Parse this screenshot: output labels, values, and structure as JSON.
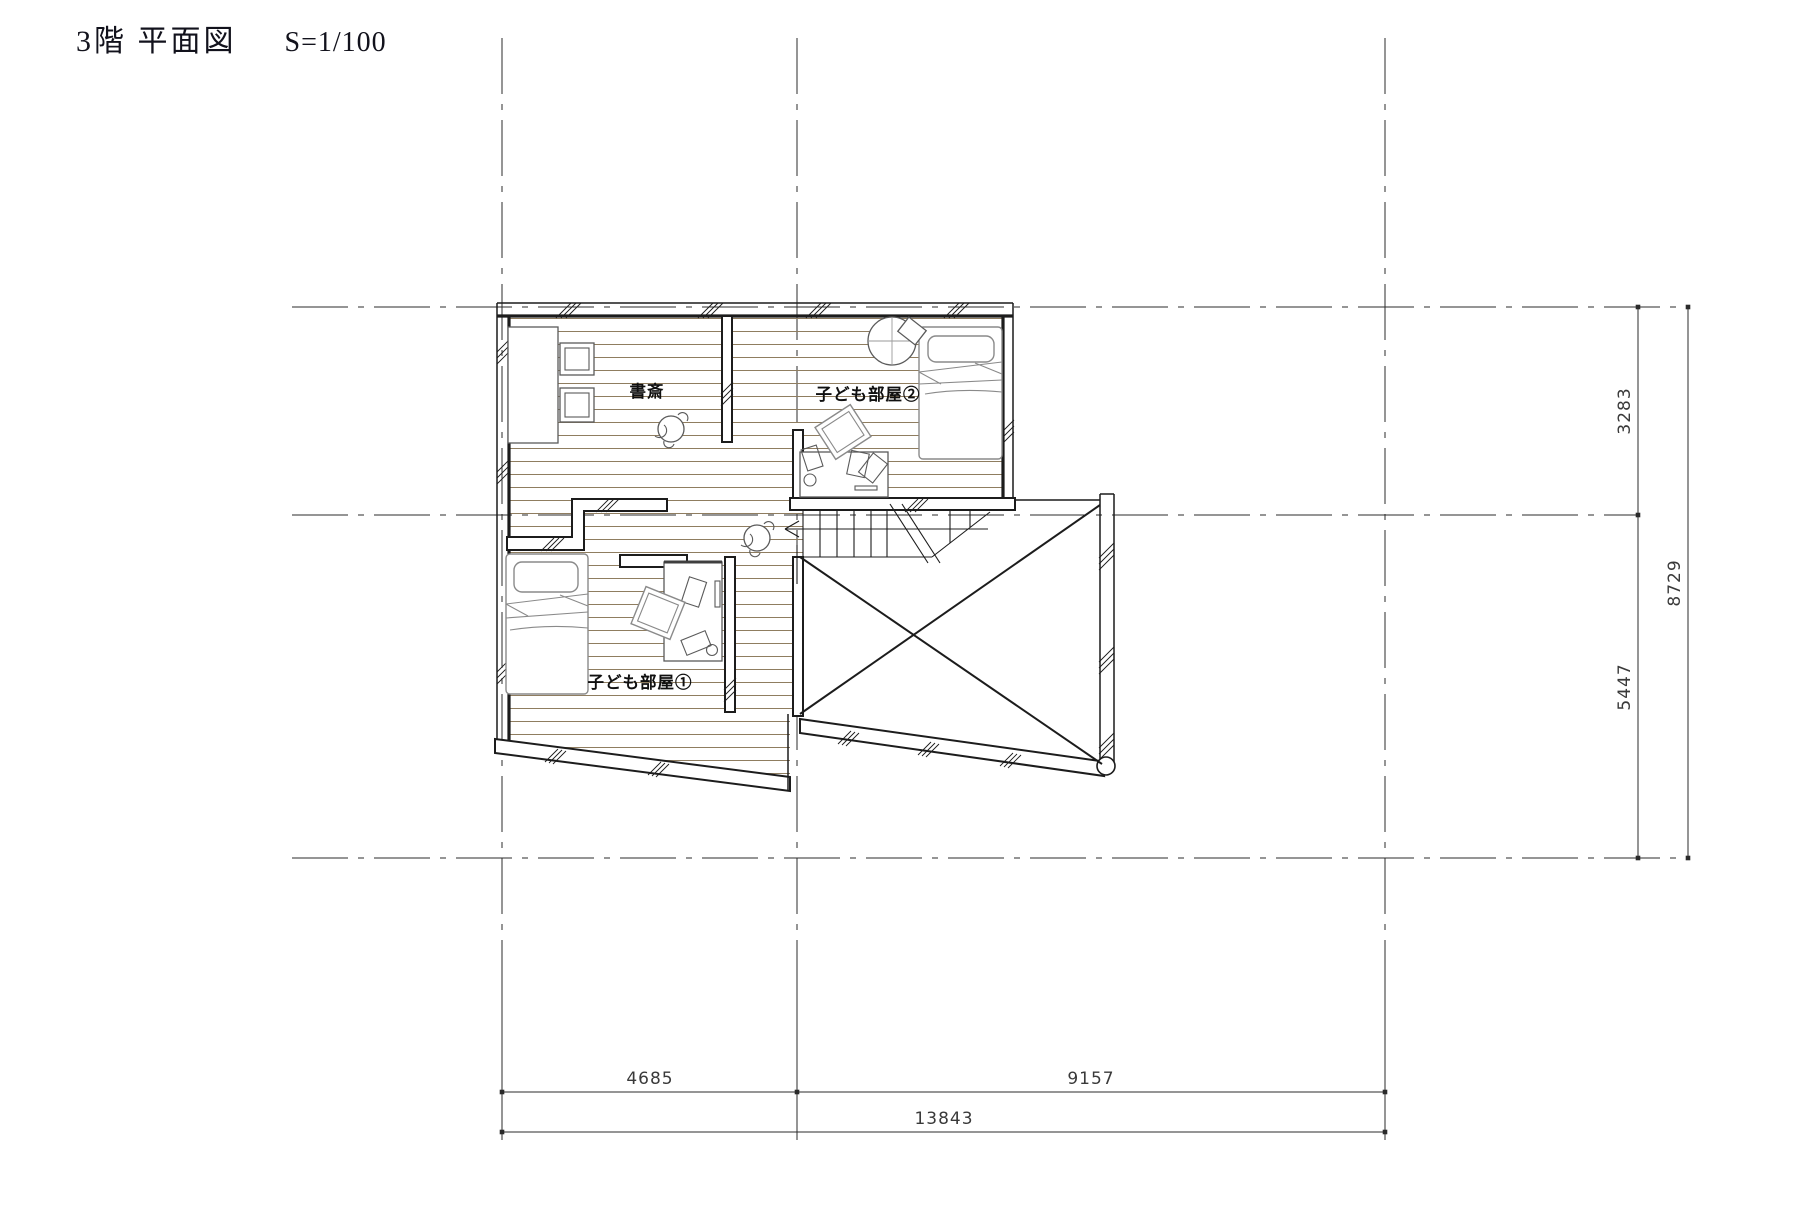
{
  "title": {
    "text": "3階 平面図",
    "scale": "S=1/100"
  },
  "rooms": {
    "study": {
      "label": "書斎"
    },
    "kids_room_2": {
      "label": "子ども部屋②"
    },
    "kids_room_1": {
      "label": "子ども部屋①"
    }
  },
  "dimensions": {
    "right": {
      "segment_top": "3283",
      "segment_bottom": "5447",
      "total": "8729"
    },
    "bottom": {
      "segment_left": "4685",
      "segment_right": "9157",
      "total": "13843"
    }
  },
  "colors": {
    "line": "#1c1c1c",
    "floor_hatch": "#8f7d60",
    "furniture": "#5a5a5a"
  }
}
